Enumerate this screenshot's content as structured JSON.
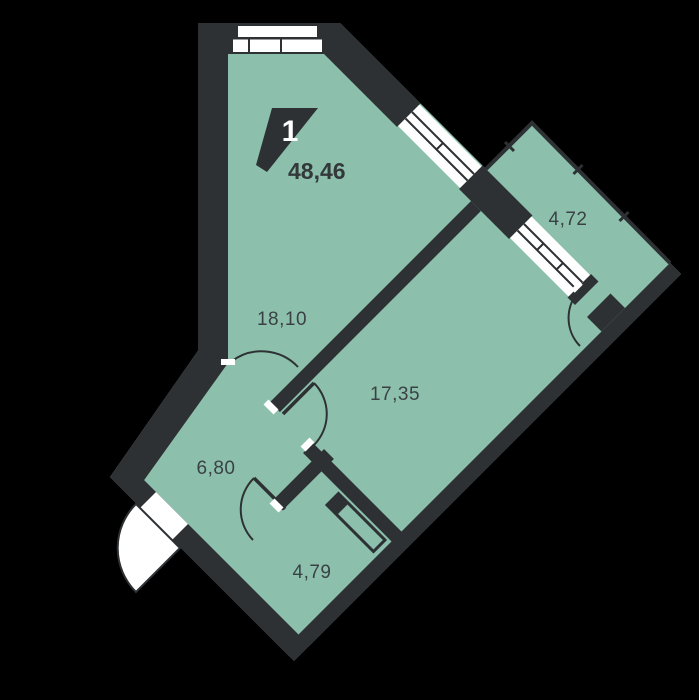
{
  "plan": {
    "unit_number": "1",
    "total_area": "48,46",
    "rooms": [
      {
        "name": "room-large",
        "area": "18,10"
      },
      {
        "name": "room-living",
        "area": "17,35"
      },
      {
        "name": "hallway",
        "area": "6,80"
      },
      {
        "name": "bathroom",
        "area": "4,79"
      },
      {
        "name": "balcony",
        "area": "4,72"
      }
    ],
    "colors": {
      "background": "#000000",
      "floor": "#8DC0AC",
      "wall": "#2D3134",
      "window": "#FFFFFF",
      "label_text": "#3A4145"
    }
  }
}
